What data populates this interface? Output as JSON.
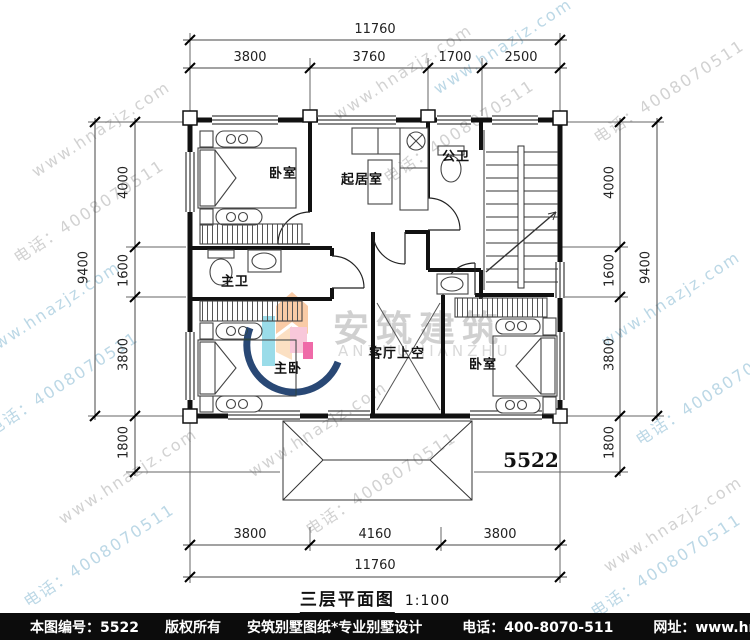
{
  "watermark": {
    "site": "www.hnazjz.com",
    "phone": "电话：4008070511"
  },
  "logo": {
    "name": "安筑建筑",
    "latin": "ANZHU JIANZHU"
  },
  "plan": {
    "number": "5522",
    "title": "三层平面图",
    "scale": "1:100",
    "rooms": {
      "bedroom_top": "卧室",
      "living": "起居室",
      "public_bath": "公卫",
      "master_bath": "主卫",
      "master_bedroom": "主卧",
      "void": "客厅上空",
      "bedroom_bottom": "卧室"
    }
  },
  "dimensions": {
    "top": {
      "overall": "11760",
      "segments": [
        "3800",
        "3760",
        "1700",
        "2500"
      ]
    },
    "bottom": {
      "overall": "11760",
      "segments": [
        "3800",
        "4160",
        "3800"
      ]
    },
    "left": {
      "overall": "9400",
      "segments": [
        "4000",
        "1600",
        "3800",
        "1800"
      ]
    },
    "right": {
      "overall": "9400",
      "segments": [
        "4000",
        "1600",
        "3800",
        "1800"
      ]
    }
  },
  "footer": {
    "id_label": "本图编号：5522",
    "copyright": "版权所有",
    "studio": "安筑别墅图纸*专业别墅设计",
    "phone": "电话：400-8070-511",
    "site": "网址：www.hnazjz.com"
  },
  "colors": {
    "wall": "#111111",
    "dim_line": "#444444",
    "watermark_gray": "#d2d2d2",
    "watermark_blue": "#bcd8e6",
    "logo_orange": "#f9cba6",
    "logo_pink": "#f8c8da",
    "logo_cyan": "#9adce9",
    "logo_magenta": "#ef6aa8",
    "logo_navy": "#1d3e6e"
  }
}
